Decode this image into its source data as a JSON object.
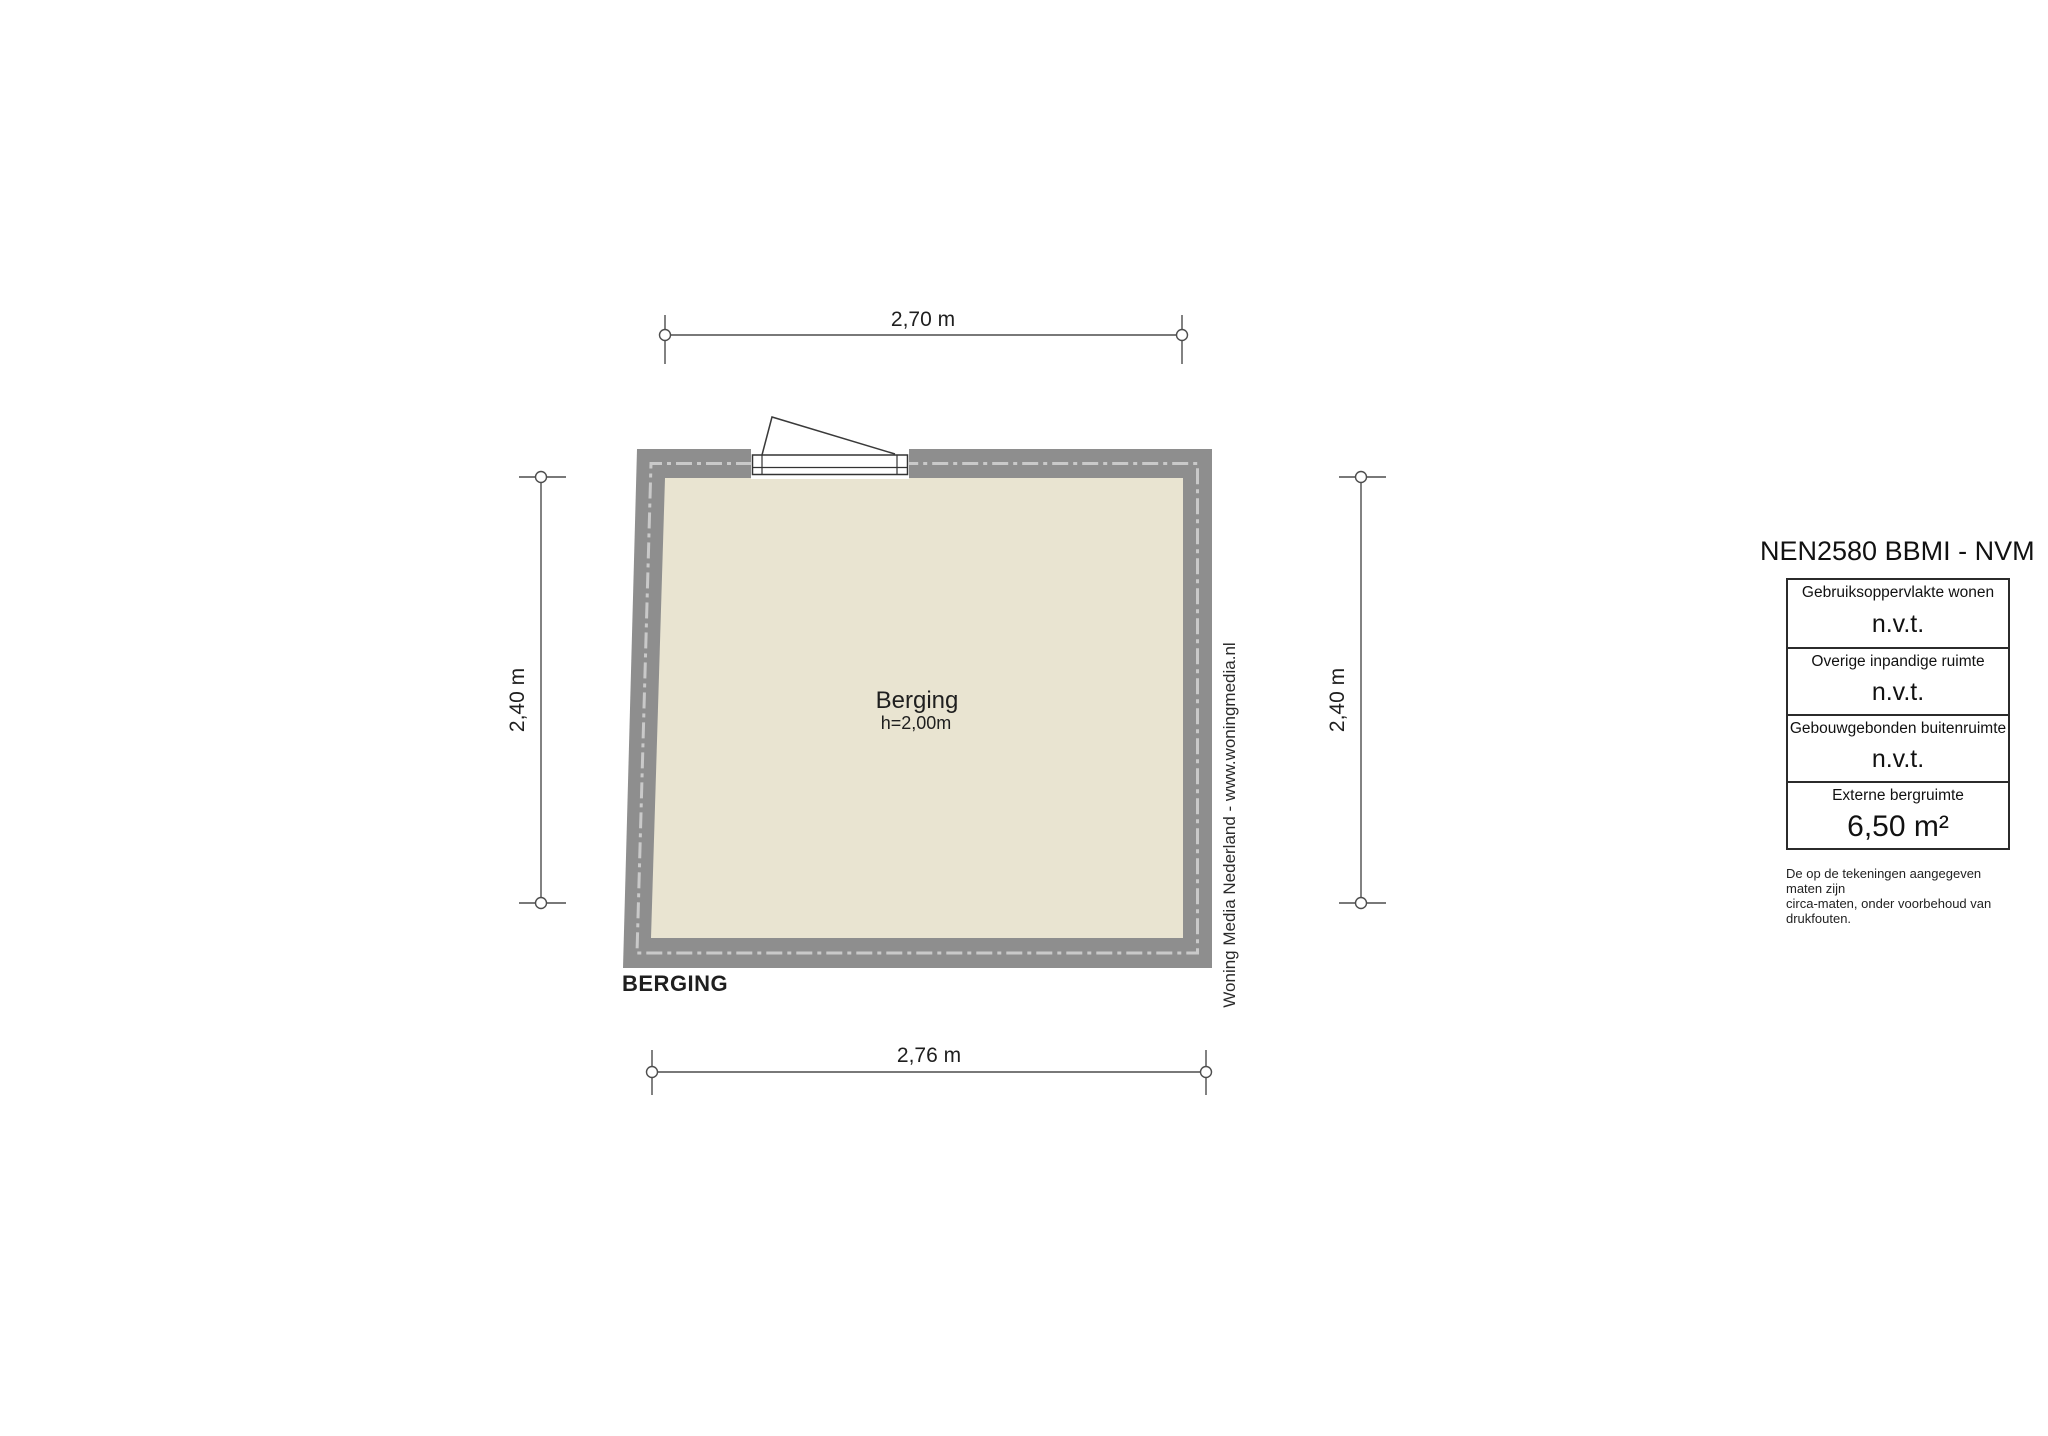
{
  "plan": {
    "room_label": "Berging",
    "room_height": "h=2,00m",
    "plan_title": "BERGING",
    "watermark": "Woning Media Nederland - www.woningmedia.nl",
    "dimensions": {
      "top": "2,70 m",
      "bottom": "2,76 m",
      "left": "2,40 m",
      "right": "2,40 m"
    }
  },
  "legend": {
    "title": "NEN2580 BBMI - NVM",
    "rows": [
      {
        "label": "Gebruiksoppervlakte wonen",
        "value": "n.v.t."
      },
      {
        "label": "Overige inpandige ruimte",
        "value": "n.v.t."
      },
      {
        "label": "Gebouwgebonden buitenruimte",
        "value": "n.v.t."
      },
      {
        "label": "Externe bergruimte",
        "value": "6,50 m²"
      }
    ],
    "disclaimer_line1": "De op de tekeningen aangegeven maten zijn",
    "disclaimer_line2": "circa-maten, onder voorbehoud van drukfouten."
  },
  "colors": {
    "wall": "#8e8e8e",
    "floor": "#e9e4d1",
    "wall_dash": "#c9c9c9",
    "dim_line": "#4d4d4d"
  }
}
